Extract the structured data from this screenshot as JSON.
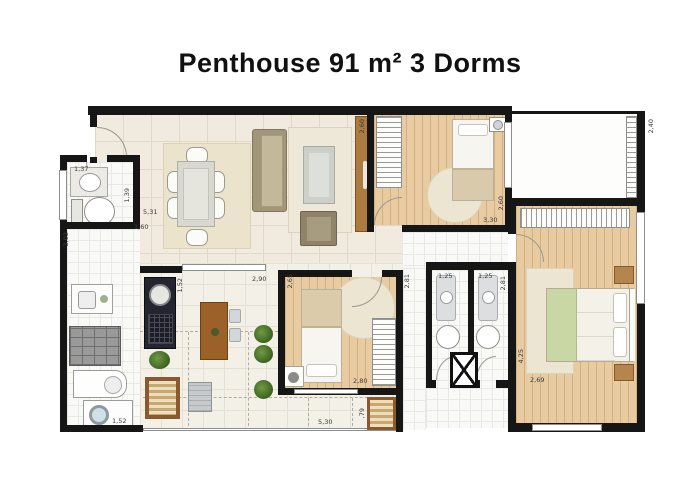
{
  "title": "Penthouse 91 m² 3 Dorms",
  "summary": {
    "area_m2": "91",
    "bedrooms": "3",
    "unit_type": "Penthouse"
  },
  "dimensions": {
    "lavabo_width": "1,37",
    "lavabo_depth": "1,39",
    "hall_width": "1,60",
    "service_length": "3,02",
    "living_width": "5,31",
    "rack_length": "2,60",
    "kitchen_width": "2,90",
    "counter_length": "1,52",
    "service_width": "1,52",
    "terrace_length": "5,30",
    "lounger_width": ",79",
    "bedroom2_depth": "2,65",
    "bedroom2_width": "2,80",
    "hall2_depth": "2,81",
    "hall3_depth": "2,81",
    "bath1_width": "1,25",
    "bath2_width": "1,25",
    "bedroom1_depth": "2,60",
    "bedroom1_width": "3,30",
    "master_depth": "4,25",
    "master_width": "2,69",
    "master_window": "2,40"
  },
  "colors": {
    "wall": "#161616",
    "wood_floor": "#e8cba1",
    "tile_living": "#f0eadf",
    "tile_white": "#f9f9f7",
    "rug": "#ece4d0",
    "sofa": "#a2967a",
    "wood_furniture": "#9b6129",
    "bbq_counter": "#252531",
    "plant_green": "#4c7a2e",
    "master_blanket_green": "#c8d7a4",
    "single_bed_blanket": "#dbcbaa"
  }
}
